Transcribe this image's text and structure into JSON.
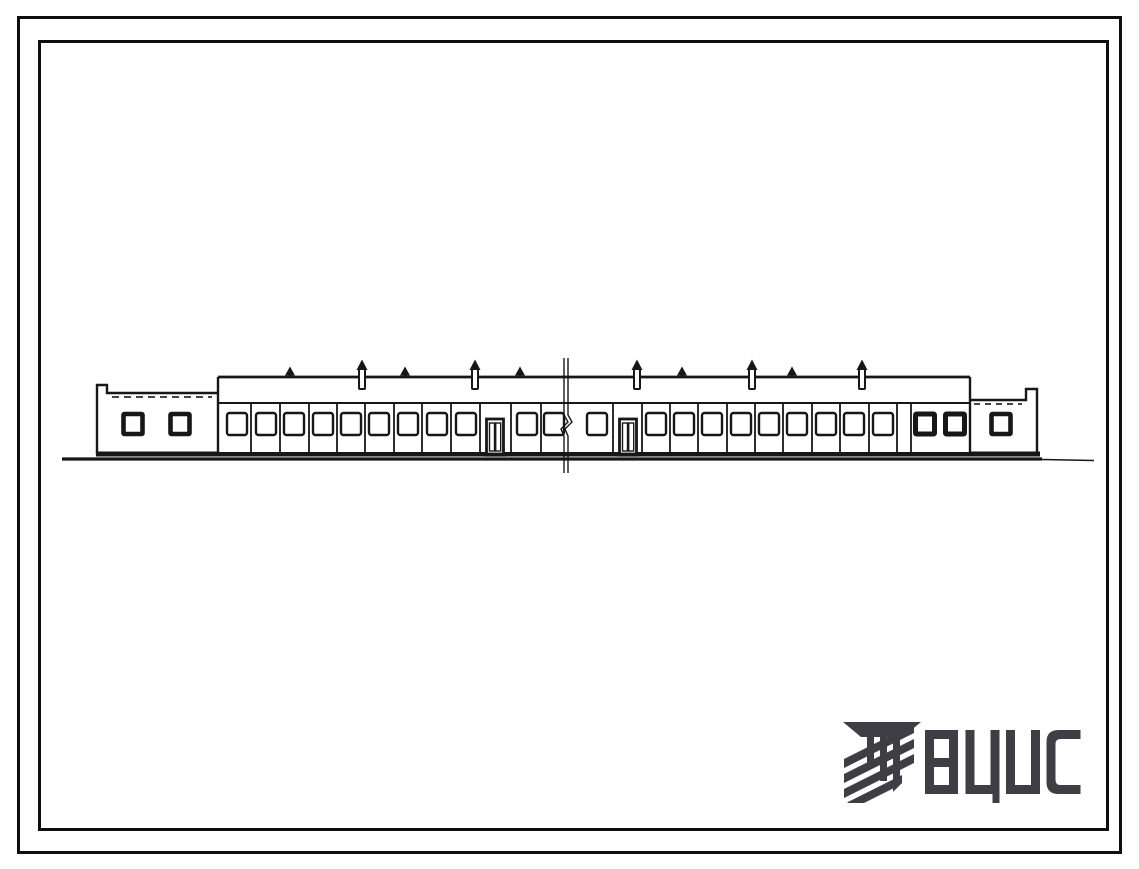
{
  "sheet": {
    "background": "#ffffff",
    "border_color": "#0e0e0e"
  },
  "logo": {
    "text": "ВЦИС",
    "color": "#3e3e44",
    "icon": "vcis-emblem-icon"
  },
  "elevation": {
    "ink": "#171717",
    "ground": {
      "x1": 62,
      "x_thick_end": 1042,
      "x2": 1094,
      "y": 459
    },
    "base_band": {
      "x1": 96,
      "x2": 1040,
      "y": 454
    },
    "left_wing": {
      "x": 97,
      "top": 393,
      "notch_x": 107,
      "notch_top": 385,
      "bottom": 455,
      "window_centers": [
        133,
        180
      ]
    },
    "right_wing": {
      "x": 1037,
      "top": 400,
      "notch_x": 1026,
      "notch_top": 389,
      "bottom": 455,
      "window_centers": [
        1001
      ]
    },
    "main_block": {
      "x1": 218,
      "x2": 970,
      "top": 377,
      "fascia_y": 403,
      "bottom": 452
    },
    "joints": [
      251,
      280,
      309,
      337,
      365,
      394,
      422,
      451,
      480,
      511,
      541,
      613,
      642,
      670,
      698,
      727,
      755,
      783,
      812,
      840,
      869,
      897,
      911
    ],
    "windows_light_centers": [
      237,
      266,
      294,
      323,
      351,
      379,
      408,
      437,
      466,
      527,
      554,
      597,
      656,
      684,
      712,
      741,
      769,
      797,
      826,
      854,
      883
    ],
    "windows_dark_centers": [
      925,
      955
    ],
    "door_centers": [
      495,
      628
    ],
    "window": {
      "y": 413,
      "w": 20,
      "h": 22
    },
    "dark_window": {
      "y": 414,
      "w": 19,
      "h": 20
    },
    "door": {
      "y": 419,
      "w": 17,
      "h": 35
    },
    "vents": [
      {
        "x": 290,
        "type": "small"
      },
      {
        "x": 362,
        "type": "tall"
      },
      {
        "x": 405,
        "type": "small"
      },
      {
        "x": 475,
        "type": "tall"
      },
      {
        "x": 520,
        "type": "small"
      },
      {
        "x": 637,
        "type": "tall"
      },
      {
        "x": 682,
        "type": "small"
      },
      {
        "x": 752,
        "type": "tall"
      },
      {
        "x": 792,
        "type": "small"
      },
      {
        "x": 862,
        "type": "tall"
      }
    ],
    "break_line": {
      "x": 564,
      "x2": 568,
      "y1": 358,
      "y2": 473
    }
  }
}
